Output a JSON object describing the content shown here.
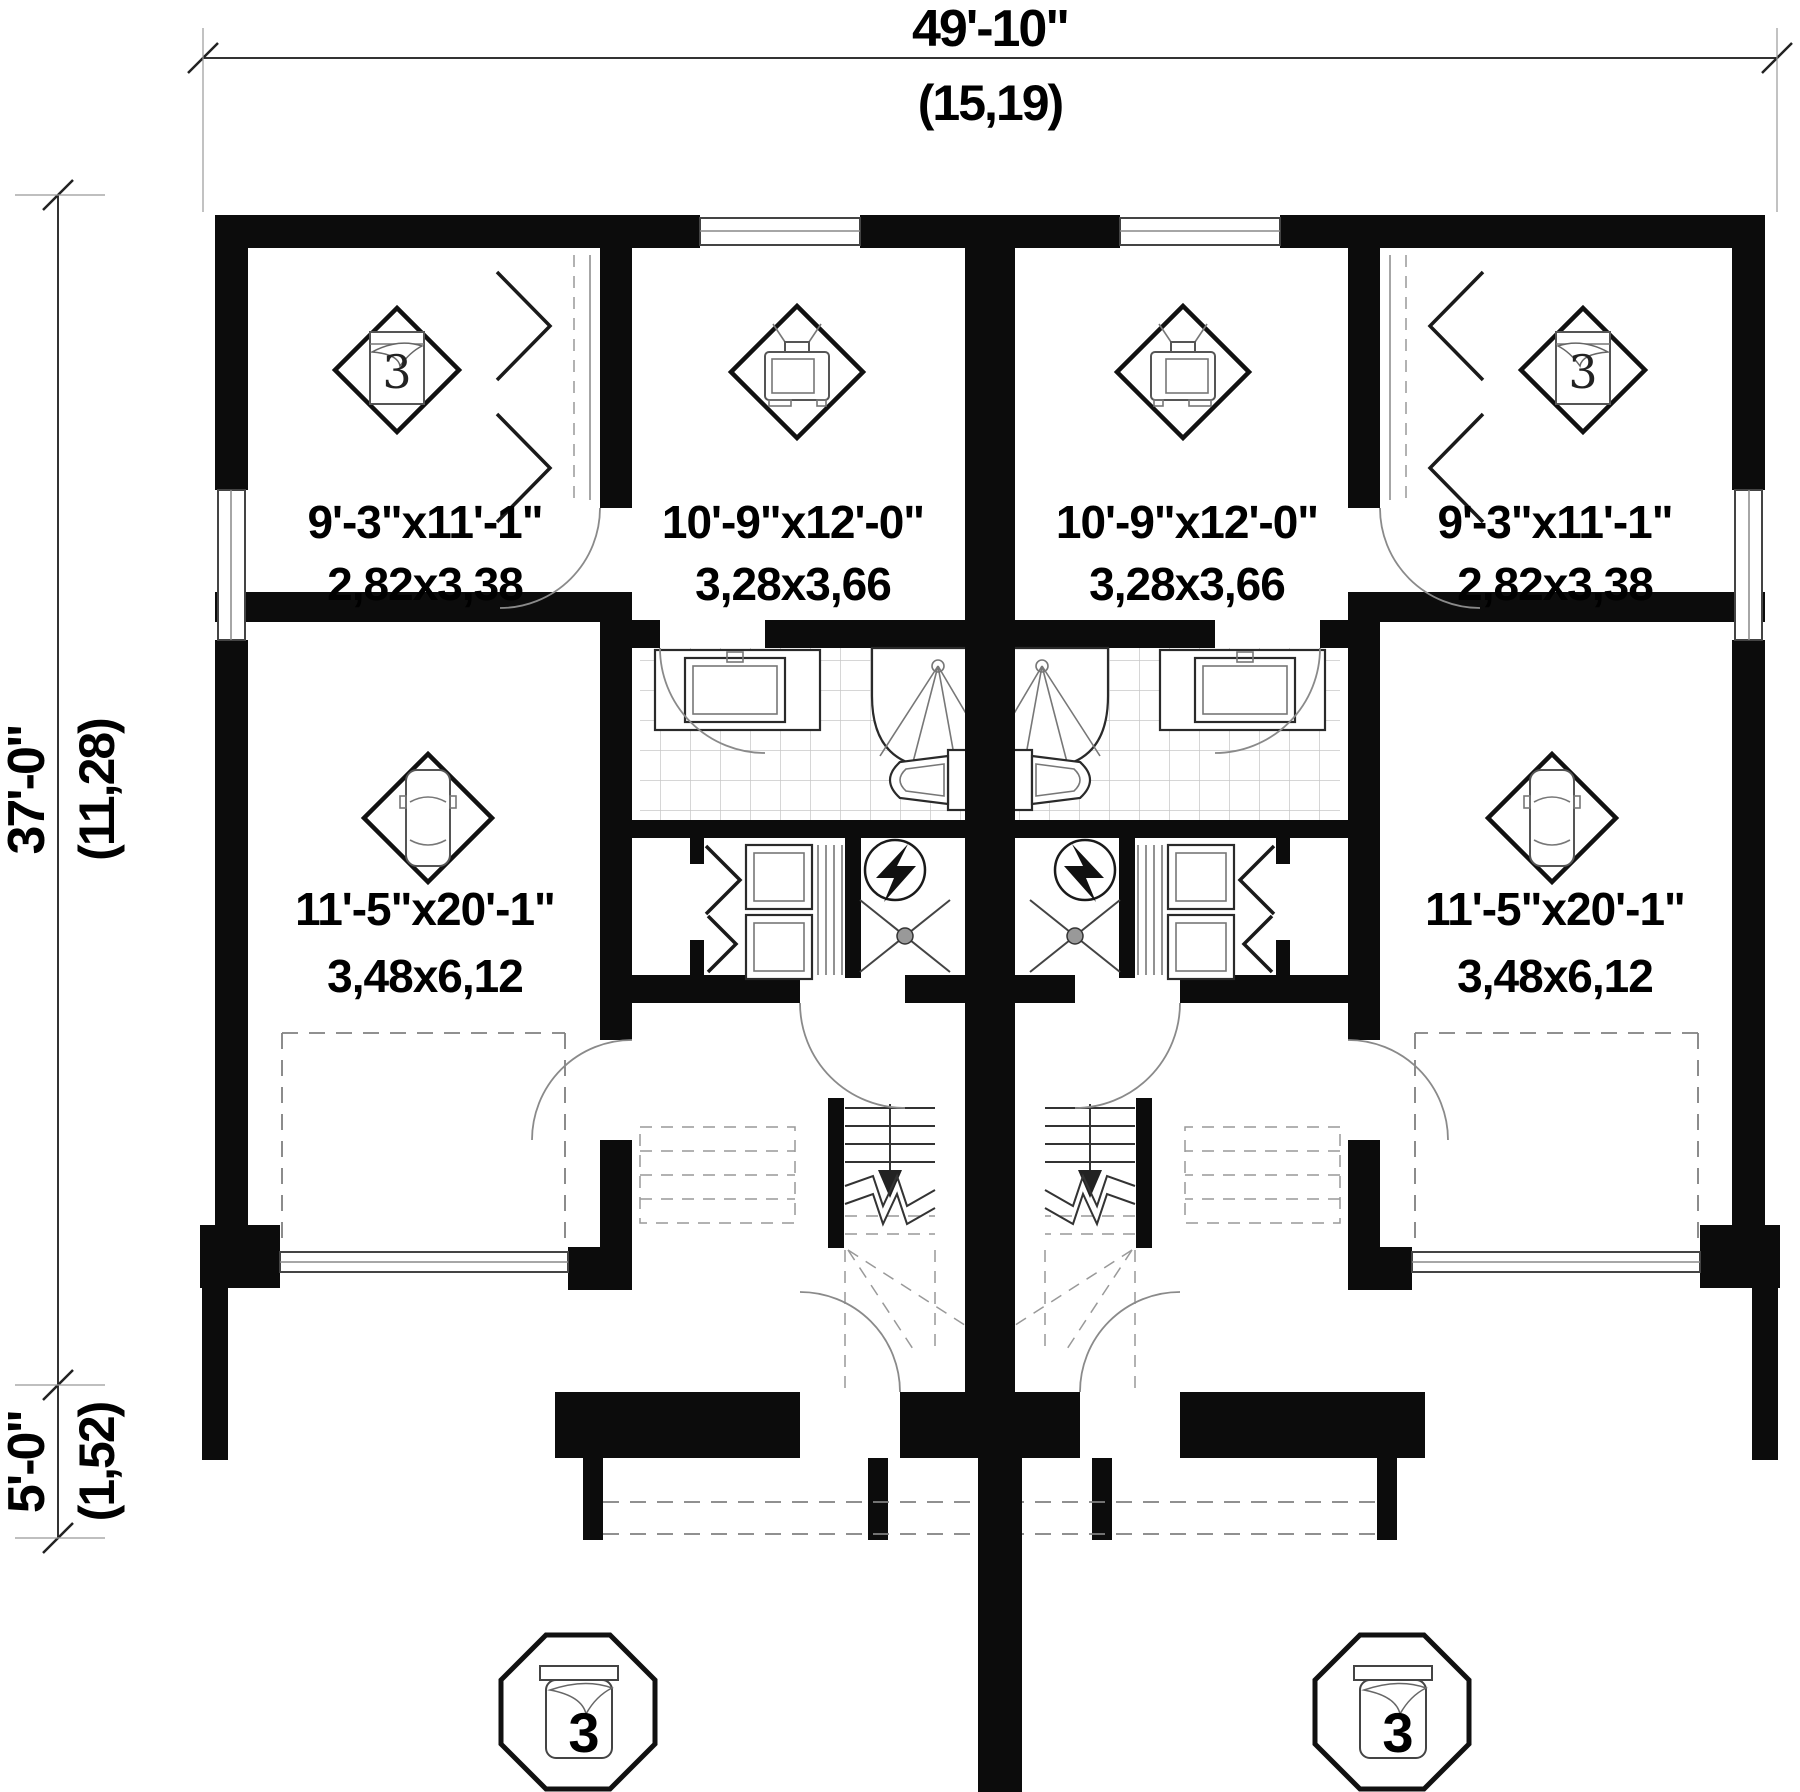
{
  "dimensions": {
    "overall_width": {
      "imperial": "49'-10\"",
      "metric": "(15,19)"
    },
    "overall_depth": {
      "imperial": "37'-0\"",
      "metric": "(11,28)"
    },
    "porch_depth": {
      "imperial": "5'-0\"",
      "metric": "(1,52)"
    }
  },
  "rooms": {
    "bedroom_left": {
      "imperial": "9'-3\"x11'-1\"",
      "metric": "2,82x3,38"
    },
    "living_left": {
      "imperial": "10'-9\"x12'-0\"",
      "metric": "3,28x3,66"
    },
    "garage_left": {
      "imperial": "11'-5\"x20'-1\"",
      "metric": "3,48x6,12"
    },
    "bedroom_right": {
      "imperial": "9'-3\"x11'-1\"",
      "metric": "2,82x3,38"
    },
    "living_right": {
      "imperial": "10'-9\"x12'-0\"",
      "metric": "3,28x3,66"
    },
    "garage_right": {
      "imperial": "11'-5\"x20'-1\"",
      "metric": "3,48x6,12"
    }
  },
  "icons": {
    "bedroom_number": "3"
  },
  "badges": {
    "left": "3",
    "right": "3"
  },
  "colors": {
    "wall": "#0c0c0c",
    "paper": "#ffffff",
    "tile_grid": "#c8c8c8"
  }
}
